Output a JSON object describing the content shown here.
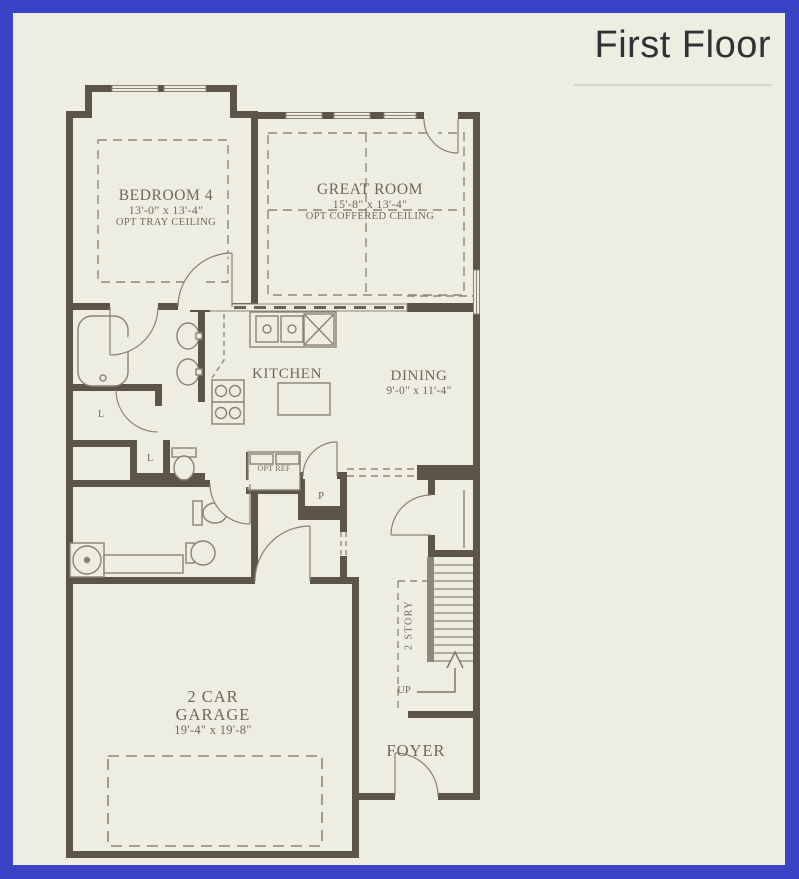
{
  "title": "First Floor",
  "colors": {
    "frame_border": "#3a43c5",
    "background": "#eeede2",
    "walls": "#5b5447",
    "linework": "#8a8273",
    "label_text": "#6f685a",
    "title_text": "#2e3336"
  },
  "rooms": {
    "bedroom4": {
      "name": "BEDROOM 4",
      "dimensions": "13'-0\" x 13'-4\"",
      "option": "OPT TRAY CEILING"
    },
    "great_room": {
      "name": "GREAT ROOM",
      "dimensions": "15'-8\" x 13'-4\"",
      "option": "OPT COFFERED CEILING"
    },
    "kitchen": {
      "name": "KITCHEN"
    },
    "dining": {
      "name": "DINING",
      "dimensions": "9'-0\" x 11'-4\""
    },
    "garage": {
      "name_line1": "2 CAR",
      "name_line2": "GARAGE",
      "dimensions": "19'-4\" x 19'-8\""
    },
    "foyer": {
      "name": "FOYER"
    }
  },
  "annotations": {
    "optional_refrigerator": "OPT REF",
    "pantry": "P",
    "linen_closet_1": "L",
    "linen_closet_2": "L",
    "two_story": "2 STORY",
    "stairs_up": "UP"
  }
}
